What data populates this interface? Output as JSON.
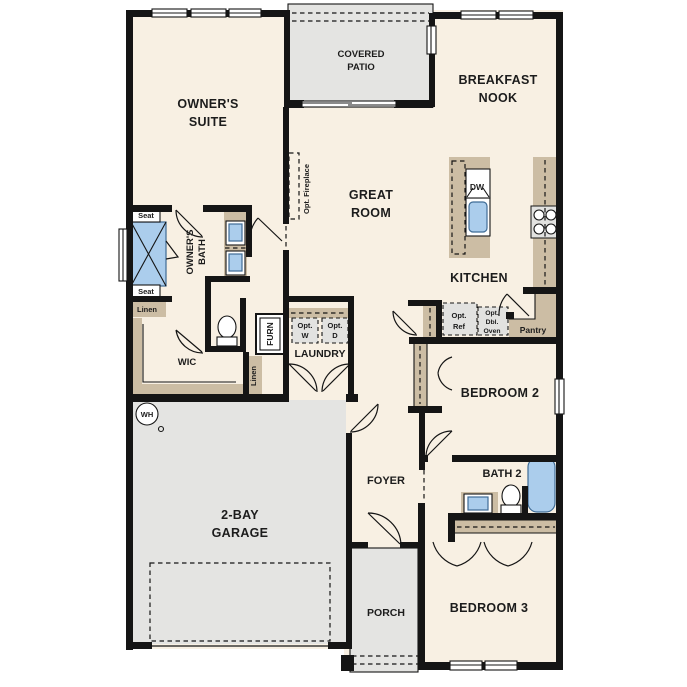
{
  "rooms": {
    "owners_suite": {
      "l1": "OWNER'S",
      "l2": "SUITE"
    },
    "covered_patio": {
      "l1": "COVERED",
      "l2": "PATIO"
    },
    "breakfast_nook": {
      "l1": "BREAKFAST",
      "l2": "NOOK"
    },
    "great_room": {
      "l1": "GREAT",
      "l2": "ROOM"
    },
    "kitchen": {
      "label": "KITCHEN"
    },
    "owners_bath": {
      "l1": "OWNER'S",
      "l2": "BATH"
    },
    "wic": {
      "label": "WIC"
    },
    "laundry": {
      "label": "LAUNDRY"
    },
    "bedroom2": {
      "label": "BEDROOM 2"
    },
    "bath2": {
      "label": "BATH 2"
    },
    "bedroom3": {
      "label": "BEDROOM 3"
    },
    "foyer": {
      "label": "FOYER"
    },
    "porch": {
      "label": "PORCH"
    },
    "garage": {
      "l1": "2-BAY",
      "l2": "GARAGE"
    },
    "pantry": {
      "label": "Pantry"
    }
  },
  "fixtures": {
    "seat_top": "Seat",
    "seat_bottom": "Seat",
    "linen_hall": "Linen",
    "linen_closet": "Linen",
    "furnace": "FURN",
    "water_heater": "WH",
    "dishwasher": "DW",
    "opt_washer": {
      "l1": "Opt.",
      "l2": "W"
    },
    "opt_dryer": {
      "l1": "Opt.",
      "l2": "D"
    },
    "opt_ref": {
      "l1": "Opt.",
      "l2": "Ref"
    },
    "opt_dbl_oven": {
      "l1": "Opt.",
      "l2": "Dbl.",
      "l3": "Oven"
    },
    "opt_fireplace": "Opt. Fireplace"
  },
  "colors": {
    "bg": "#ffffff",
    "floor": "#f8f0e3",
    "outdoor": "#e4e4e2",
    "cabinet": "#ccbda4",
    "fixture": "#abcdec",
    "fixstroke": "#3f6c96",
    "appliance": "#e2e2e0",
    "wall": "#151515",
    "line": "#1c1c1c"
  }
}
